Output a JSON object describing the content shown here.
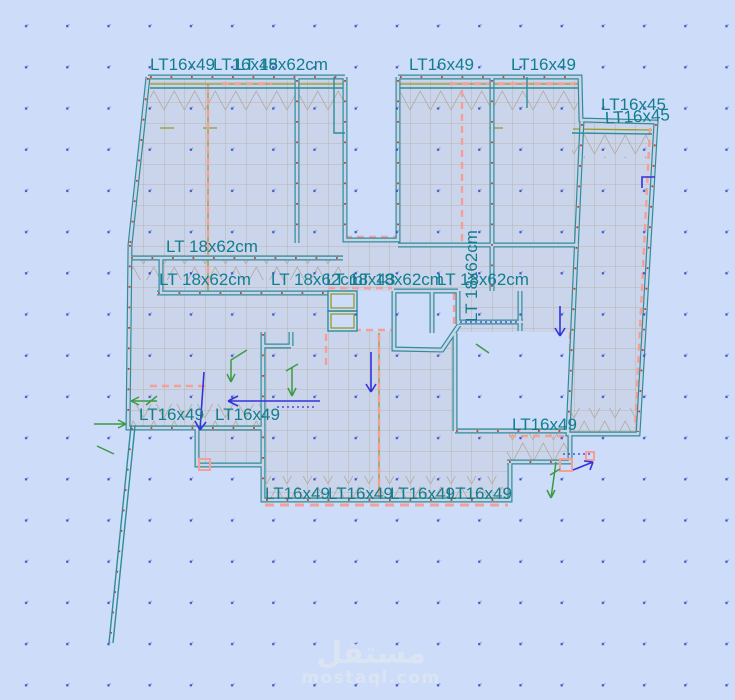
{
  "view": {
    "description": "Structural floor-slab FEM model plan view with beam labels",
    "background_color": "#cddcf8",
    "slab_color": "#cad5eb",
    "mesh_color": "#b3aaa0",
    "beam_color": "#2f8c98",
    "label_color": "#127d8e",
    "dashed_color": "#f59f97",
    "node_color": "#c8392c",
    "load_color": "#3333dd",
    "aux_color": "#3c9a45"
  },
  "beam_labels": [
    "LT16x49",
    "LT16x45",
    "LT 18x62cm",
    "LT16x49",
    "LT16x49",
    "LT16x45",
    "LT16x45",
    "LT 18x62cm",
    "LT 18x62cm",
    "LT 18x62cm",
    "LT 18x43",
    "LT 18x62cm",
    "LT 18x62cm",
    "LT 18x62cm",
    "LT16x49",
    "LT16x49",
    "LT16x49",
    "LT16x49",
    "LT16x49",
    "LT16x49",
    "LT16x49"
  ],
  "watermark": {
    "name": "مستقل",
    "domain": "mostaql.com"
  }
}
